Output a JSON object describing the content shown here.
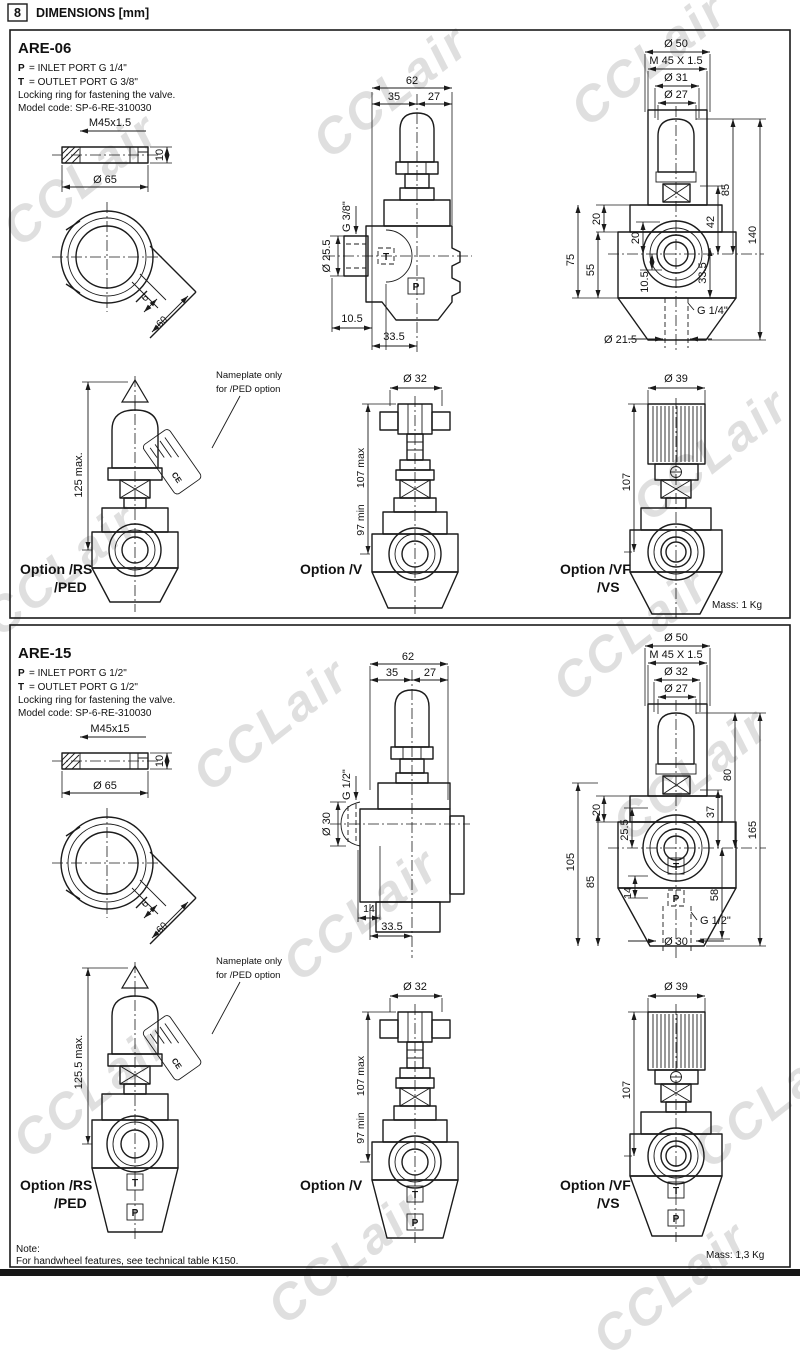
{
  "header": {
    "page_num": "8",
    "title": "DIMENSIONS [mm]"
  },
  "watermark": {
    "text": "CCLair"
  },
  "are06": {
    "title": "ARE-06",
    "line_p_bold": "P",
    "line_p": "= INLET PORT G 1/4\"",
    "line_t_bold": "T",
    "line_t": "= OUTLET PORT G 3/8\"",
    "line_lock": "Locking ring for fastening the valve.",
    "line_model": "Model code: SP-6-RE-310030",
    "ring": {
      "thread": "M45x1.5",
      "dia": "Ø 65",
      "height": "10",
      "slot": "6",
      "angle": "60"
    },
    "side": {
      "w": "62",
      "w1": "35",
      "w2": "27",
      "port": "G 3/8\"",
      "dia": "Ø 25.5",
      "off1": "10.5",
      "off2": "33.5",
      "t": "T",
      "p": "P"
    },
    "front": {
      "d1": "Ø 50",
      "d2": "M 45 X 1.5",
      "d3": "Ø 31",
      "d4": "Ø 27",
      "h1": "85",
      "h2": "42",
      "h3": "140",
      "l1": "20",
      "l2": "75",
      "l3": "55",
      "l4": "20",
      "l5": "10.5",
      "r1": "33.5",
      "port": "G 1/4\"",
      "d5": "Ø 21.5"
    },
    "opt_rs": {
      "label1": "Option /RS",
      "label2": "/PED",
      "dim": "125 max.",
      "note1": "Nameplate only",
      "note2": "for /PED option",
      "plate": "CE"
    },
    "opt_v": {
      "label": "Option /V",
      "dia": "Ø 32",
      "dmax": "107 max",
      "dmin": "97 min"
    },
    "opt_vf": {
      "label1": "Option /VF",
      "label2": "/VS",
      "dia": "Ø 39",
      "h": "107"
    },
    "mass": "Mass: 1 Kg"
  },
  "are15": {
    "title": "ARE-15",
    "line_p_bold": "P",
    "line_p": "= INLET PORT G 1/2\"",
    "line_t_bold": "T",
    "line_t": "= OUTLET PORT G 1/2\"",
    "line_lock": "Locking ring for fastening the valve.",
    "line_model": "Model code: SP-6-RE-310030",
    "ring": {
      "thread": "M45x15",
      "dia": "Ø 65",
      "height": "10",
      "slot": "6",
      "angle": "60"
    },
    "side": {
      "w": "62",
      "w1": "35",
      "w2": "27",
      "port": "G 1/2\"",
      "dia": "Ø 30",
      "off1": "14",
      "off2": "33.5"
    },
    "front": {
      "d1": "Ø 50",
      "d2": "M 45 X 1.5",
      "d3": "Ø 32",
      "d4": "Ø 27",
      "h1": "80",
      "h2": "37",
      "h3": "165",
      "l1": "20",
      "l2": "25.5",
      "l3": "105",
      "l4": "85",
      "l5": "14",
      "r1": "58",
      "port": "G 1/2\"",
      "d5": "Ø 30",
      "t": "T",
      "p": "P"
    },
    "opt_rs": {
      "label1": "Option /RS",
      "label2": "/PED",
      "dim": "125.5 max.",
      "note1": "Nameplate only",
      "note2": "for /PED option",
      "plate": "CE",
      "t": "T",
      "p": "P"
    },
    "opt_v": {
      "label": "Option /V",
      "dia": "Ø 32",
      "dmax": "107 max",
      "dmin": "97 min",
      "t": "T",
      "p": "P"
    },
    "opt_vf": {
      "label1": "Option /VF",
      "label2": "/VS",
      "dia": "Ø 39",
      "h": "107",
      "t": "T",
      "p": "P"
    },
    "mass": "Mass: 1,3 Kg",
    "note_title": "Note:",
    "note_text": "For handwheel features, see technical table K150."
  }
}
